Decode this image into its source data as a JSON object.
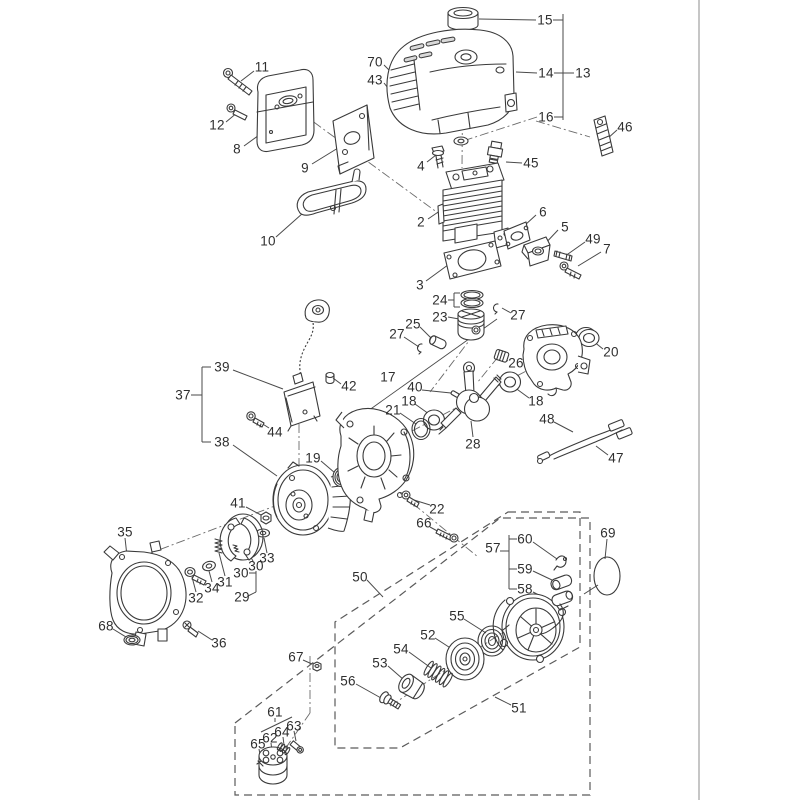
{
  "meta": {
    "background_color": "#ffffff",
    "line_color": "#3a3a3a",
    "label_color": "#2f2f2f",
    "page_divider_color": "#b3b3b3",
    "diagram_kind": "exploded parts diagram"
  },
  "diagram": {
    "labels": [
      {
        "text": "15",
        "x": 545,
        "y": 20
      },
      {
        "text": "14",
        "x": 546,
        "y": 73
      },
      {
        "text": "13",
        "x": 583,
        "y": 73
      },
      {
        "text": "16",
        "x": 546,
        "y": 117
      },
      {
        "text": "46",
        "x": 625,
        "y": 127
      },
      {
        "text": "70",
        "x": 375,
        "y": 62
      },
      {
        "text": "43",
        "x": 375,
        "y": 80
      },
      {
        "text": "11",
        "x": 262,
        "y": 67
      },
      {
        "text": "12",
        "x": 217,
        "y": 125
      },
      {
        "text": "8",
        "x": 237,
        "y": 149
      },
      {
        "text": "9",
        "x": 305,
        "y": 168
      },
      {
        "text": "10",
        "x": 268,
        "y": 241
      },
      {
        "text": "4",
        "x": 421,
        "y": 166
      },
      {
        "text": "45",
        "x": 531,
        "y": 163
      },
      {
        "text": "2",
        "x": 421,
        "y": 222
      },
      {
        "text": "6",
        "x": 543,
        "y": 212
      },
      {
        "text": "5",
        "x": 565,
        "y": 227
      },
      {
        "text": "49",
        "x": 593,
        "y": 239
      },
      {
        "text": "7",
        "x": 607,
        "y": 249
      },
      {
        "text": "3",
        "x": 420,
        "y": 285
      },
      {
        "text": "24",
        "x": 440,
        "y": 300
      },
      {
        "text": "23",
        "x": 440,
        "y": 317
      },
      {
        "text": "27",
        "x": 518,
        "y": 315
      },
      {
        "text": "25",
        "x": 413,
        "y": 324
      },
      {
        "text": "27",
        "x": 397,
        "y": 334
      },
      {
        "text": "26",
        "x": 516,
        "y": 363
      },
      {
        "text": "20",
        "x": 611,
        "y": 352
      },
      {
        "text": "17",
        "x": 388,
        "y": 377
      },
      {
        "text": "40",
        "x": 415,
        "y": 387
      },
      {
        "text": "18",
        "x": 409,
        "y": 401
      },
      {
        "text": "21",
        "x": 393,
        "y": 410
      },
      {
        "text": "18",
        "x": 536,
        "y": 401
      },
      {
        "text": "28",
        "x": 473,
        "y": 444
      },
      {
        "text": "48",
        "x": 547,
        "y": 419
      },
      {
        "text": "47",
        "x": 616,
        "y": 458
      },
      {
        "text": "37",
        "x": 183,
        "y": 395
      },
      {
        "text": "39",
        "x": 222,
        "y": 367
      },
      {
        "text": "42",
        "x": 349,
        "y": 386
      },
      {
        "text": "44",
        "x": 275,
        "y": 432
      },
      {
        "text": "38",
        "x": 222,
        "y": 442
      },
      {
        "text": "19",
        "x": 313,
        "y": 458
      },
      {
        "text": "41",
        "x": 238,
        "y": 503
      },
      {
        "text": "22",
        "x": 437,
        "y": 509
      },
      {
        "text": "66",
        "x": 424,
        "y": 523
      },
      {
        "text": "33",
        "x": 267,
        "y": 558
      },
      {
        "text": "35",
        "x": 125,
        "y": 532
      },
      {
        "text": "30",
        "x": 256,
        "y": 566
      },
      {
        "text": "30",
        "x": 241,
        "y": 573
      },
      {
        "text": "31",
        "x": 225,
        "y": 582
      },
      {
        "text": "34",
        "x": 212,
        "y": 588
      },
      {
        "text": "32",
        "x": 196,
        "y": 598
      },
      {
        "text": "29",
        "x": 242,
        "y": 597
      },
      {
        "text": "68",
        "x": 106,
        "y": 626
      },
      {
        "text": "36",
        "x": 219,
        "y": 643
      },
      {
        "text": "50",
        "x": 360,
        "y": 577
      },
      {
        "text": "57",
        "x": 493,
        "y": 548
      },
      {
        "text": "60",
        "x": 525,
        "y": 539
      },
      {
        "text": "59",
        "x": 525,
        "y": 569
      },
      {
        "text": "58",
        "x": 525,
        "y": 589
      },
      {
        "text": "69",
        "x": 608,
        "y": 533
      },
      {
        "text": "55",
        "x": 457,
        "y": 616
      },
      {
        "text": "52",
        "x": 428,
        "y": 635
      },
      {
        "text": "54",
        "x": 401,
        "y": 649
      },
      {
        "text": "53",
        "x": 380,
        "y": 663
      },
      {
        "text": "56",
        "x": 348,
        "y": 681
      },
      {
        "text": "51",
        "x": 519,
        "y": 708
      },
      {
        "text": "67",
        "x": 296,
        "y": 657
      },
      {
        "text": "61",
        "x": 275,
        "y": 712
      },
      {
        "text": "63",
        "x": 294,
        "y": 726
      },
      {
        "text": "64",
        "x": 282,
        "y": 732
      },
      {
        "text": "62",
        "x": 270,
        "y": 738
      },
      {
        "text": "65",
        "x": 258,
        "y": 744
      }
    ]
  }
}
